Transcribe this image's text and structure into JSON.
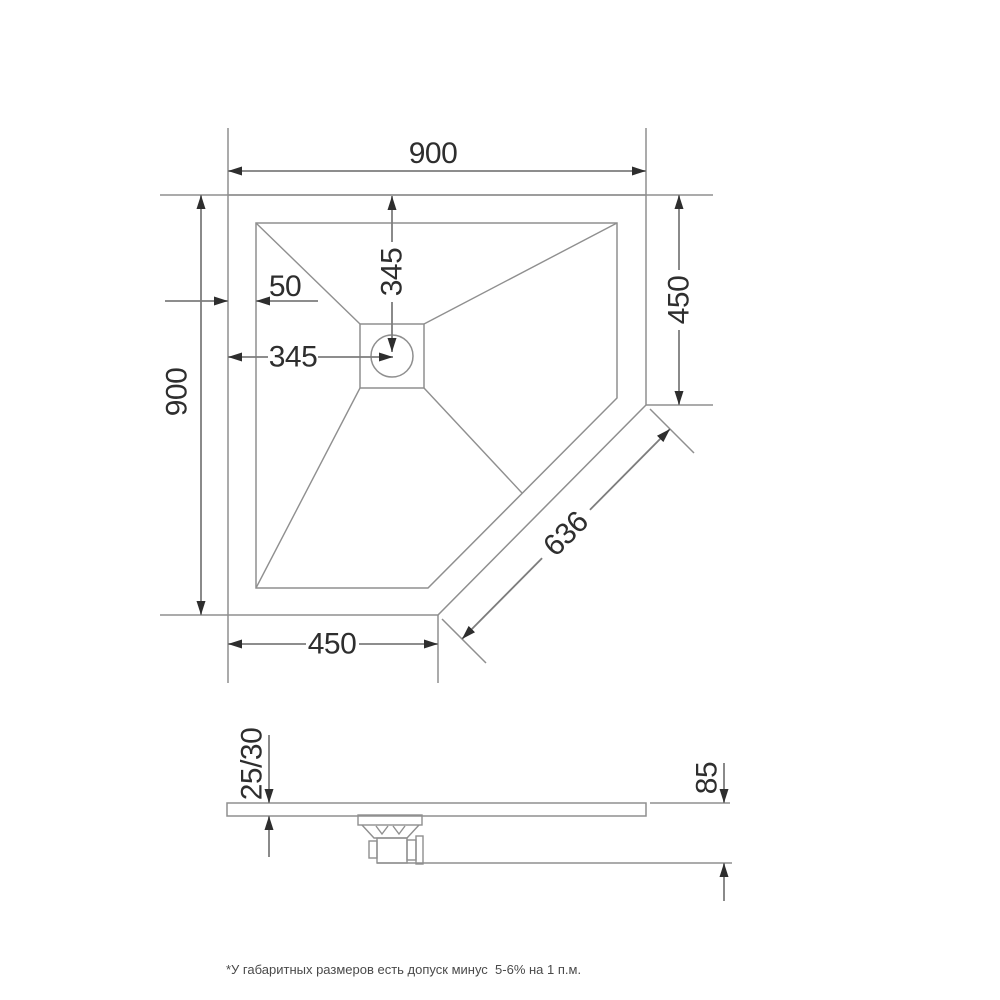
{
  "drawing_type": "shower-tray-technical-drawing",
  "plan": {
    "width_total": "900",
    "height_total": "900",
    "edge_inset": "50",
    "drain_offset_x": "345",
    "drain_offset_y": "345",
    "right_edge": "450",
    "bottom_edge": "450",
    "bevel_edge": "636"
  },
  "side": {
    "thickness": "25/30",
    "total_height": "85"
  },
  "footnote": "*У габаритных размеров есть допуск минус  5-6% на 1 п.м.",
  "colors": {
    "line": "#8f8f8f",
    "ink": "#2e2e2e",
    "background": "#ffffff"
  }
}
